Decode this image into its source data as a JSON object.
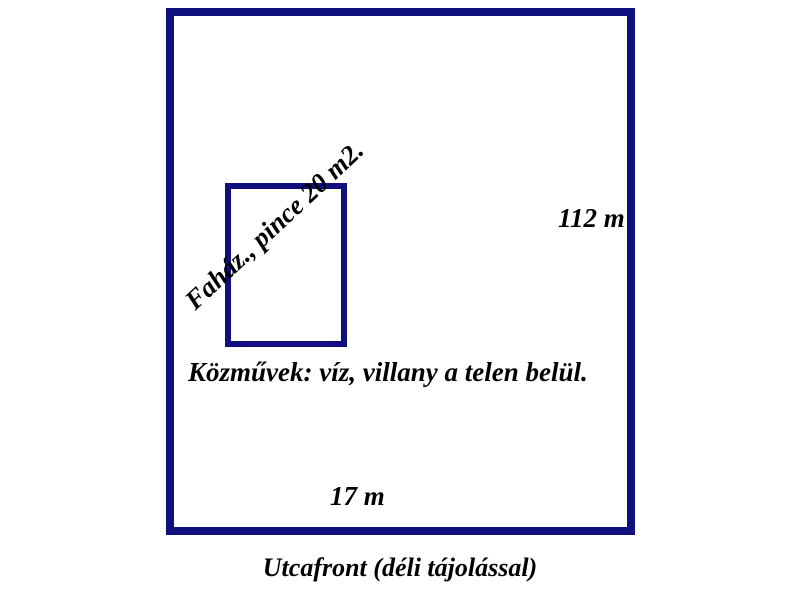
{
  "diagram": {
    "background": "#ffffff",
    "outline_color": "#0f0f7e",
    "text_color": "#000000",
    "labels": {
      "building": "Faház., pince 20 m2.",
      "side_length": "112 m",
      "utilities": "Közművek: víz, villany a telen belül.",
      "front_length": "17 m",
      "street_front": "Utcafront (déli tájolással)"
    }
  }
}
